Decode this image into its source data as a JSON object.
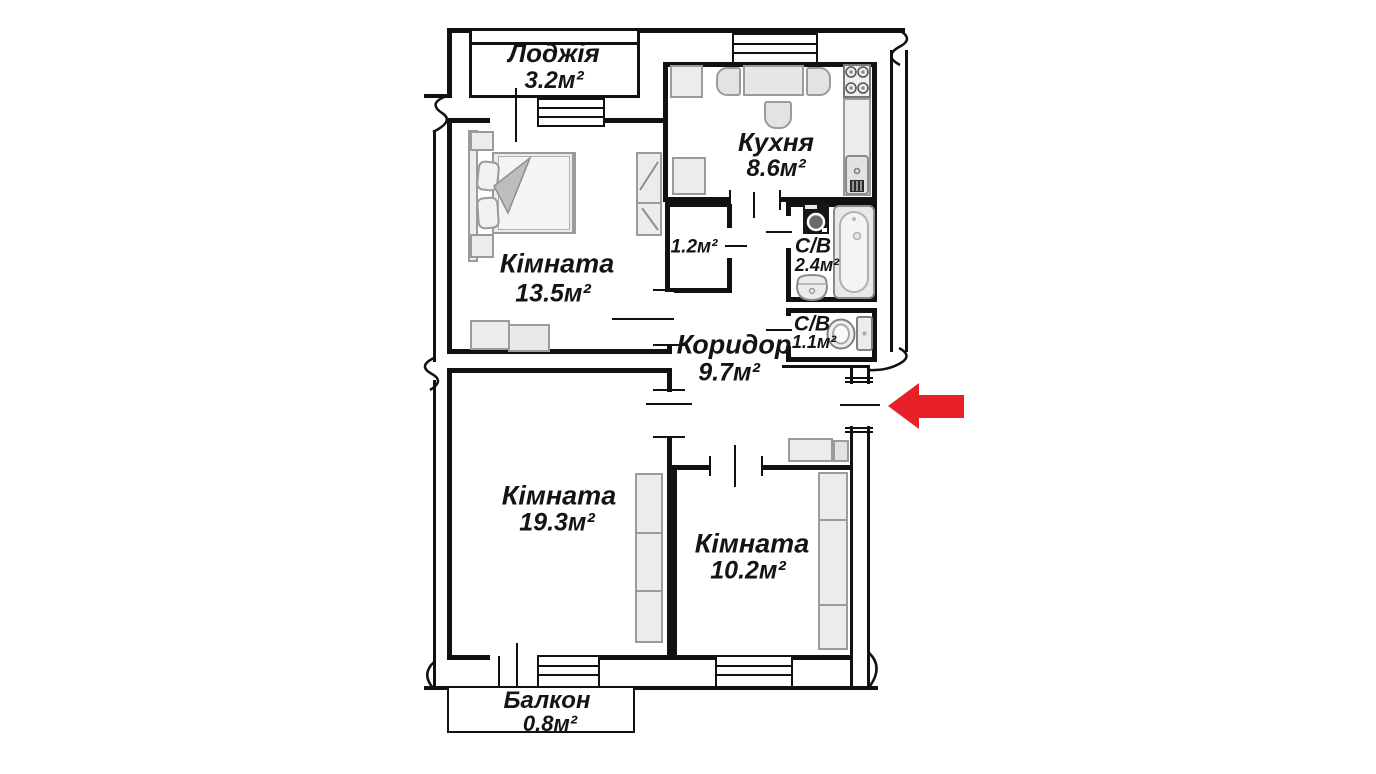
{
  "plan": {
    "rooms": [
      {
        "id": "loggia",
        "name": "Лоджія",
        "area": "3.2м²"
      },
      {
        "id": "kitchen",
        "name": "Кухня",
        "area": "8.6м²"
      },
      {
        "id": "bedroom",
        "name": "Кімната",
        "area": "13.5м²"
      },
      {
        "id": "closet",
        "name": "",
        "area": "1.2м²"
      },
      {
        "id": "bathroom",
        "name": "С/В",
        "area": "2.4м²"
      },
      {
        "id": "wc",
        "name": "С/В",
        "area": "1.1м²"
      },
      {
        "id": "corridor",
        "name": "Коридор",
        "area": "9.7м²"
      },
      {
        "id": "living-room",
        "name": "Кімната",
        "area": "19.3м²"
      },
      {
        "id": "second-room",
        "name": "Кімната",
        "area": "10.2м²"
      },
      {
        "id": "balcony",
        "name": "Балкон",
        "area": "0.8м²"
      }
    ],
    "entrance_marker": {
      "type": "arrow-left",
      "color": "#e8202a"
    },
    "colors": {
      "walls": "#111111",
      "text": "#141414",
      "furniture_fill": "#ececec",
      "furniture_stroke": "#9b9b9b"
    }
  }
}
